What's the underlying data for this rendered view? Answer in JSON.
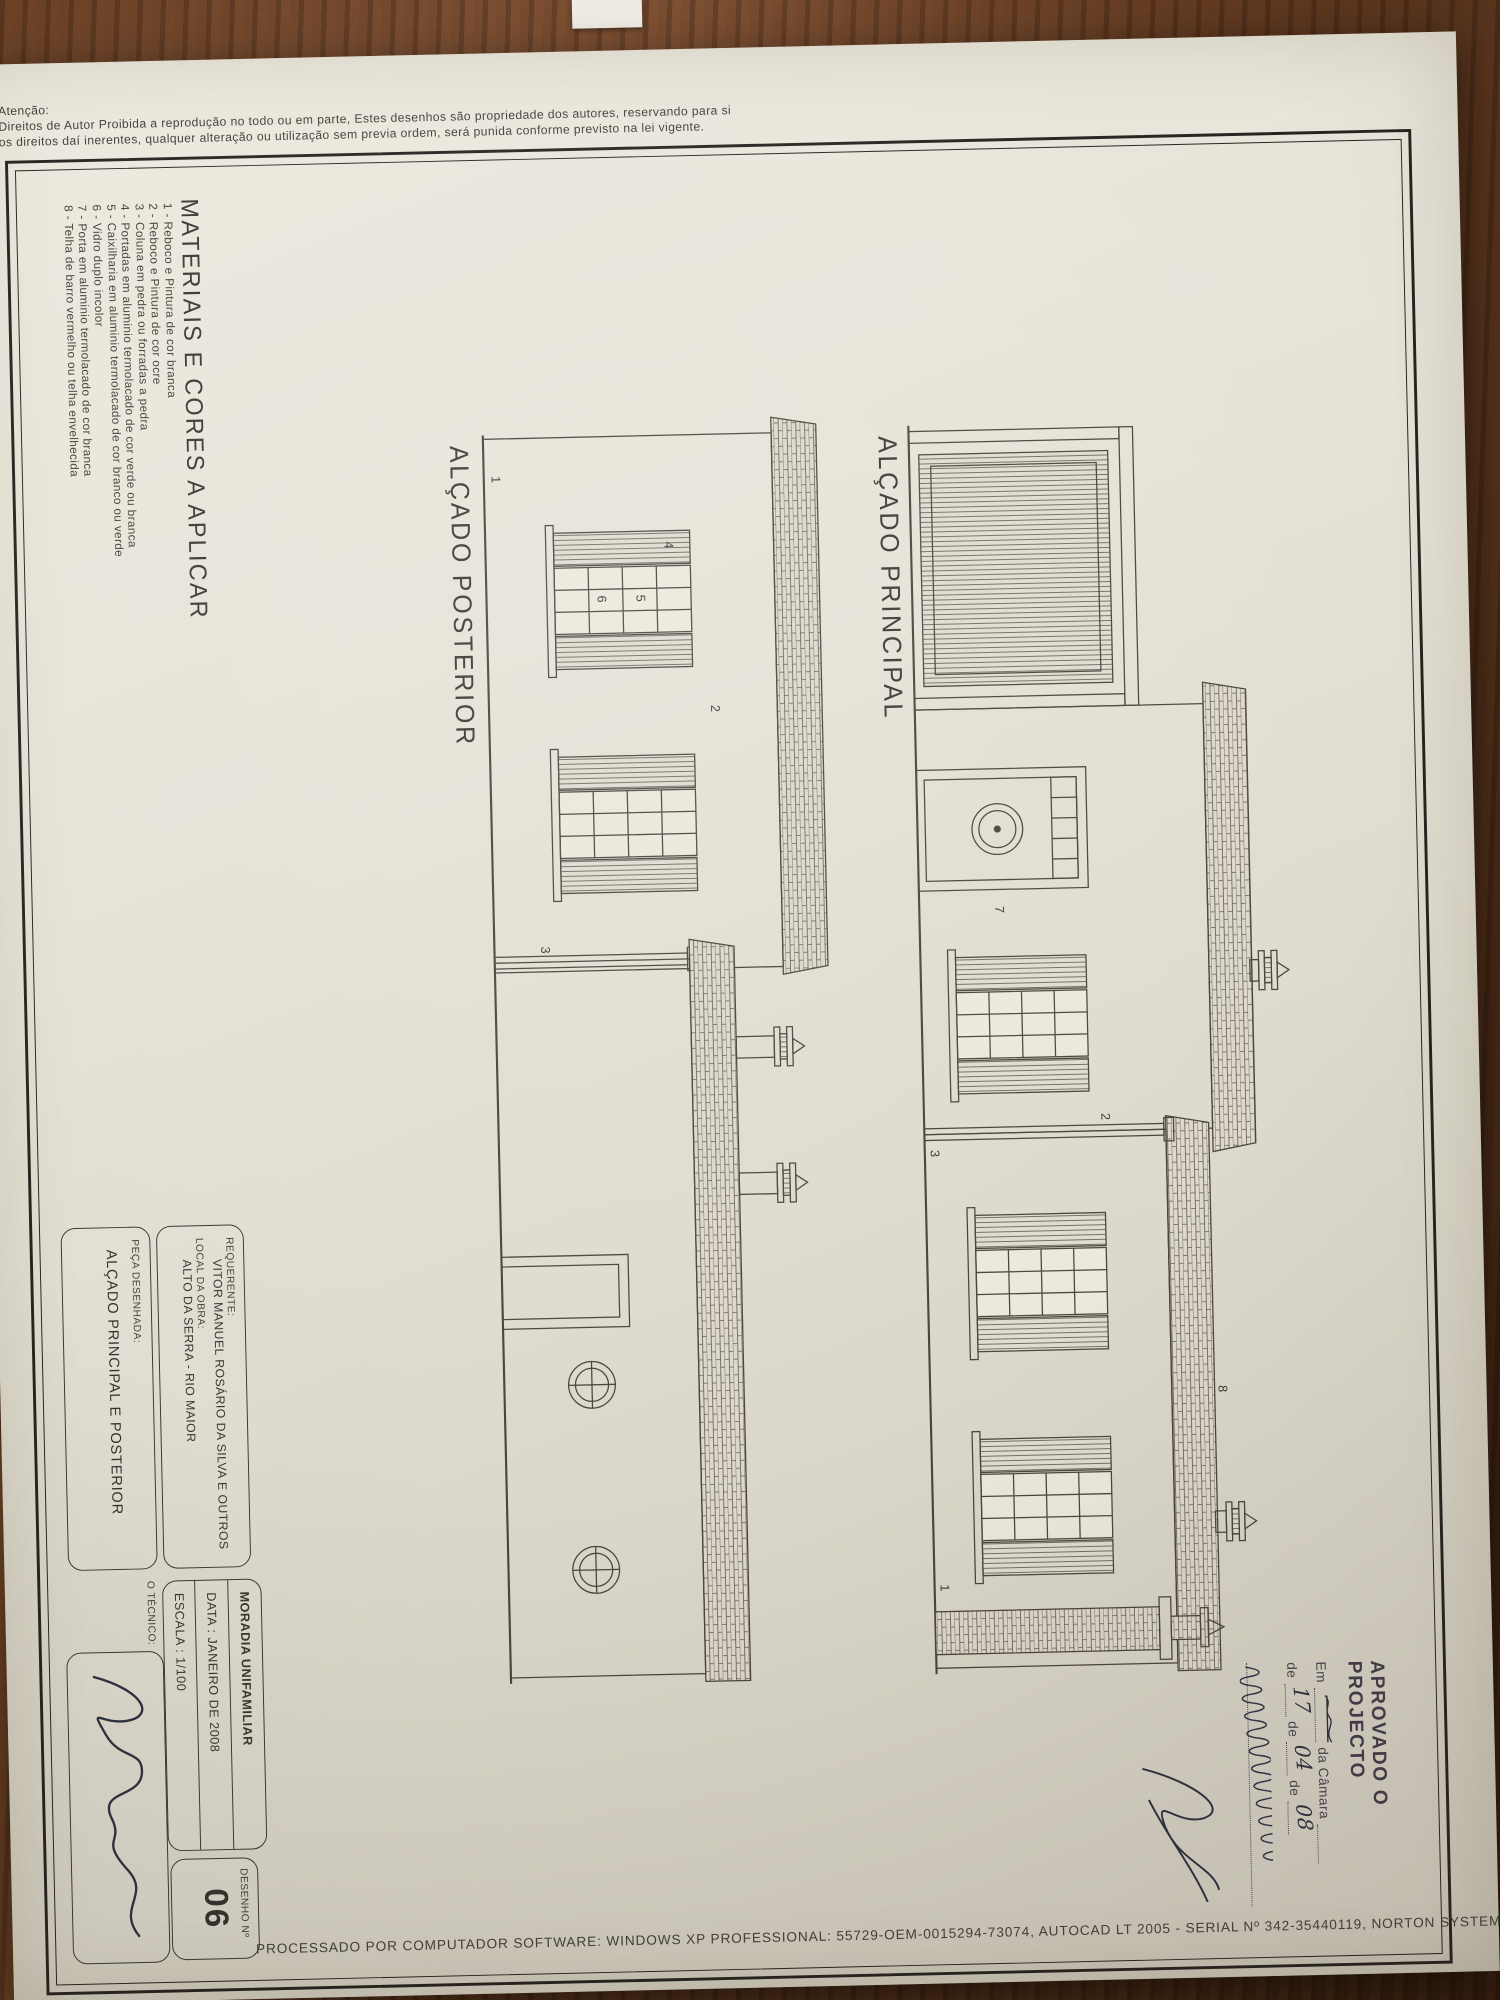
{
  "sheet": {
    "attention": {
      "heading": "Atenção:",
      "line1": "Direitos de Autor Proibida a reprodução no todo ou em parte, Estes desenhos são propriedade dos autores, reservando para si",
      "line2": "os direitos daí inerentes, qualquer alteração ou utilização sem previa ordem, será punida conforme previsto na lei vigente."
    },
    "processing_note": "PROCESSADO POR COMPUTADOR SOFTWARE: WINDOWS XP PROFESSIONAL:  55729-OEM-0015294-73074, AUTOCAD LT 2005 - SERIAL Nº  342-35440119, NORTON SYSTEMWORKS 2005 - 10286793-IN",
    "materials": {
      "heading": "MATERIAIS E CORES A APLICAR",
      "items": [
        "1 - Reboco e Pintura de cor branca",
        "2 - Reboco e Pintura de cor ocre",
        "3 - Coluna em pedra ou forradas a pedra",
        "4 - Portadas em aluminio termolacado de cor verde ou branca",
        "5 - Caixilharia em aluminio termolacado de cor branco ou verde",
        "6 - Vidro duplo incolor",
        "7 - Porta em aluminio termolacado de cor branca",
        "8 - Telha de barro vermelho ou telha envelhecida"
      ]
    },
    "elevations": {
      "principal": {
        "label": "ALÇADO PRINCIPAL",
        "annotations": {
          "door": "7",
          "wall": "2",
          "column": "3",
          "base": "1",
          "roof": "8"
        }
      },
      "posterior": {
        "label": "ALÇADO POSTERIOR",
        "annotations": {
          "wall": "2",
          "shutter": "4",
          "glass_upper": "5",
          "glass_lower": "6",
          "column": "3",
          "base": "1"
        }
      }
    },
    "title_block": {
      "requerente_label": "REQUERENTE:",
      "requerente_value": "VITOR MANUEL ROSÁRIO DA SILVA E OUTROS",
      "local_label": "LOCAL DA OBRA:",
      "local_value": "ALTO DA SERRA - RIO MAIOR",
      "projecto": "MORADIA UNIFAMILIAR",
      "data": "DATA : JANEIRO DE 2008",
      "escala": "ESCALA : 1/100",
      "desenho_label": "DESENHO  Nº",
      "desenho_value": "06",
      "peca_label": "PEÇA DESENHADA:",
      "peca_value": "ALÇADO PRINCIPAL E POSTERIOR",
      "tecnico_label": "O TÉCNICO:"
    },
    "approval_stamp": {
      "title": "APROVADO O PROJECTO",
      "em_label": "Em",
      "camara_label": "da Câmara",
      "de_label_1": "de",
      "de_label_2": "de",
      "de_label_3": "de",
      "handwritten_day": "17",
      "handwritten_month": "04",
      "handwritten_year": "08"
    }
  }
}
